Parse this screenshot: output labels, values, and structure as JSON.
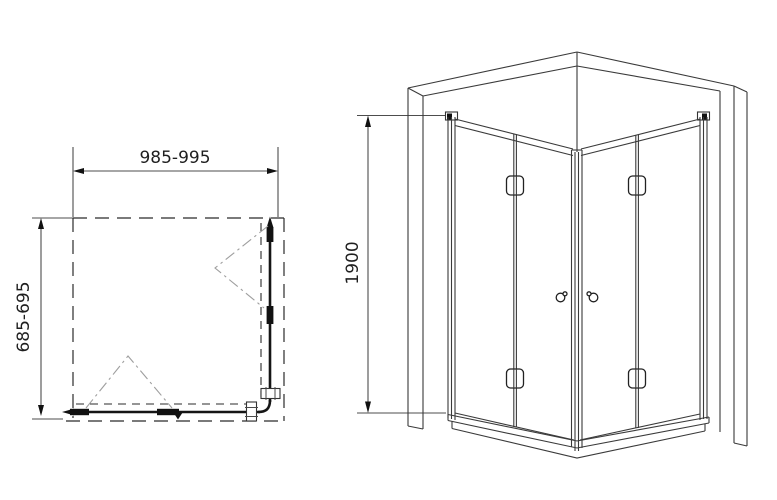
{
  "colors": {
    "background": "#ffffff",
    "main_line": "#2b2b2b",
    "thick_line": "#151515",
    "dimension_line": "#4d4d4d",
    "fold_path_line": "#9e9e9e"
  },
  "plan_view": {
    "width_dimension": "985-995",
    "depth_dimension": "685-695"
  },
  "perspective_view": {
    "height_dimension": "1900"
  }
}
